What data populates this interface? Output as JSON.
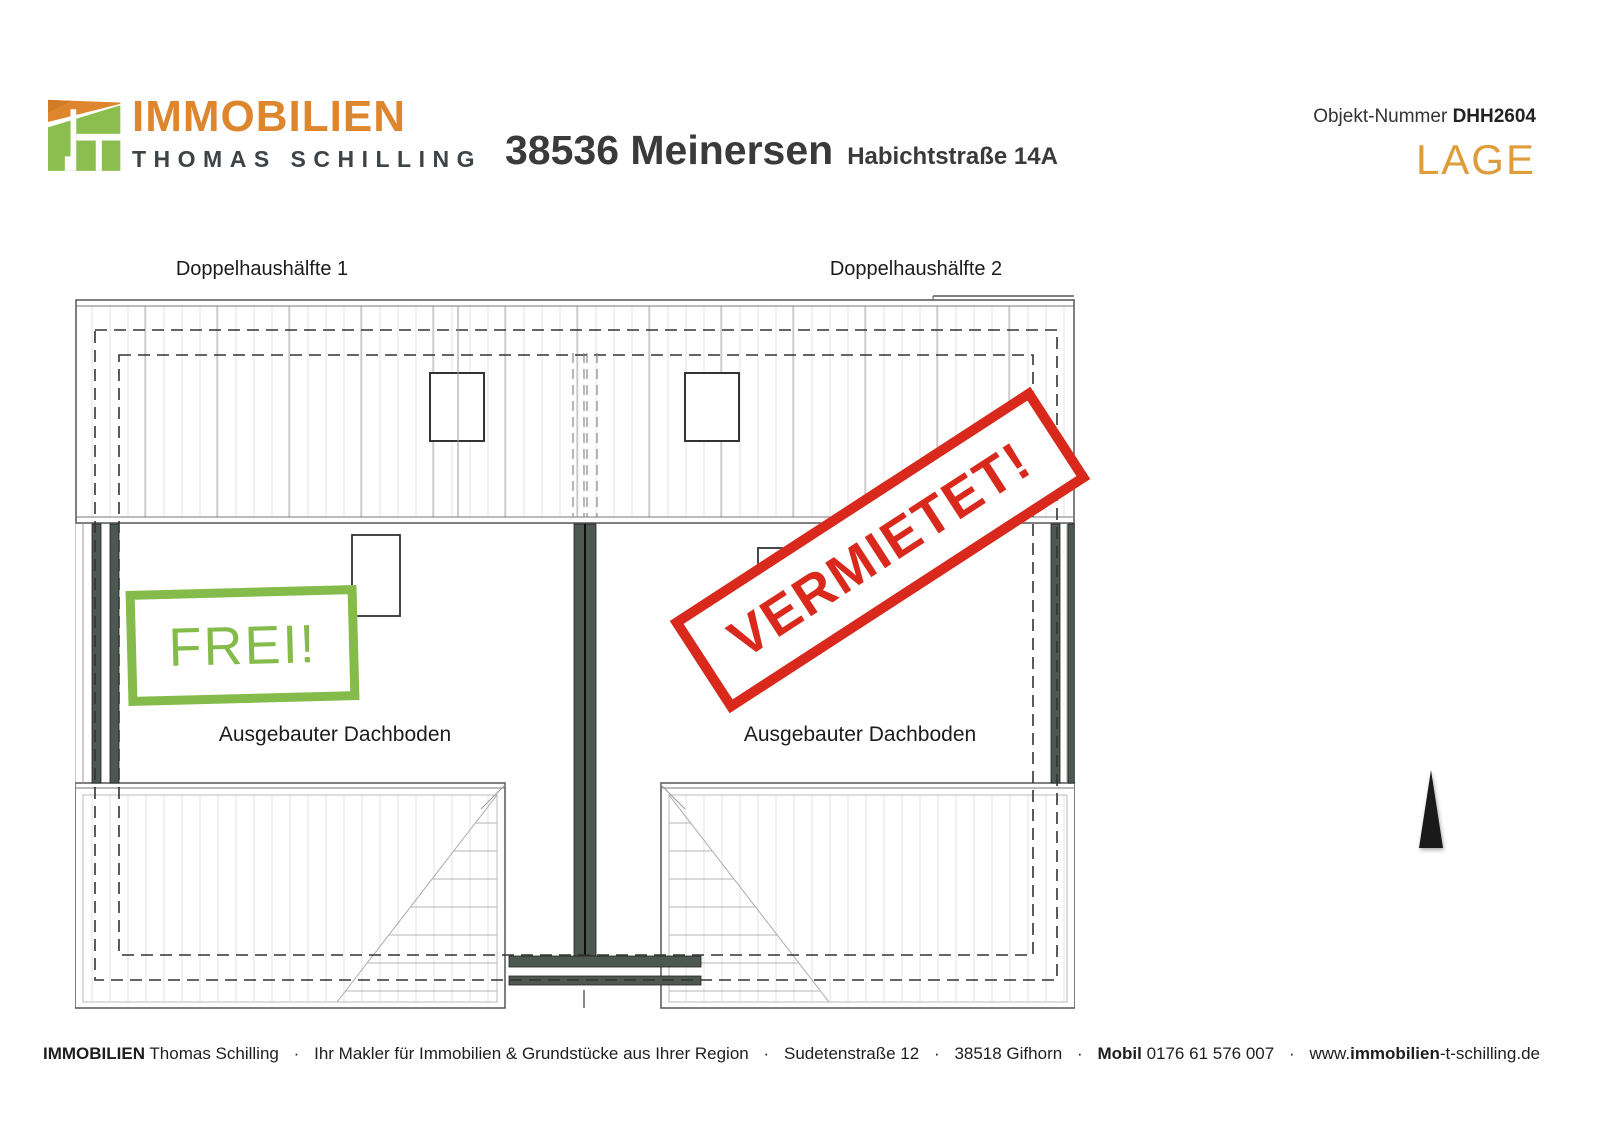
{
  "header": {
    "logo": {
      "brand": "IMMOBILIEN",
      "owner": "THOMAS SCHILLING"
    },
    "title": "38536 Meinersen",
    "subtitle": "Habichtstraße 14A",
    "object_number_label": "Objekt-Nummer ",
    "object_number": "DHH2604",
    "page_tag": "LAGE"
  },
  "plan": {
    "unit_labels": [
      "Doppelhaushälfte 1",
      "Doppelhaushälfte 2"
    ],
    "room_label_left": "Ausgebauter Dachboden",
    "room_label_right": "Ausgebauter Dachboden",
    "stamp_free": "FREI!",
    "stamp_rented": "VERMIETET!"
  },
  "footer": {
    "brand_bold": "IMMOBILIEN",
    "brand_rest": " Thomas Schilling",
    "sep": "·",
    "tagline": "Ihr Makler für Immobilien & Grundstücke aus Ihrer Region",
    "street": "Sudetenstraße 12",
    "city": "38518 Gifhorn",
    "mobile_label": "Mobil",
    "mobile_number": " 0176 61 576 007",
    "web_prefix": "www.",
    "web_bold": "immobilien",
    "web_suffix": "-t-schilling.de"
  },
  "colors": {
    "brand_orange": "#DE862D",
    "brand_green": "#8CBE4F",
    "accent_orange": "#DE9C3B",
    "stamp_green": "#85BB4B",
    "stamp_red": "#D9291C",
    "wall_dark": "#4E5852"
  }
}
